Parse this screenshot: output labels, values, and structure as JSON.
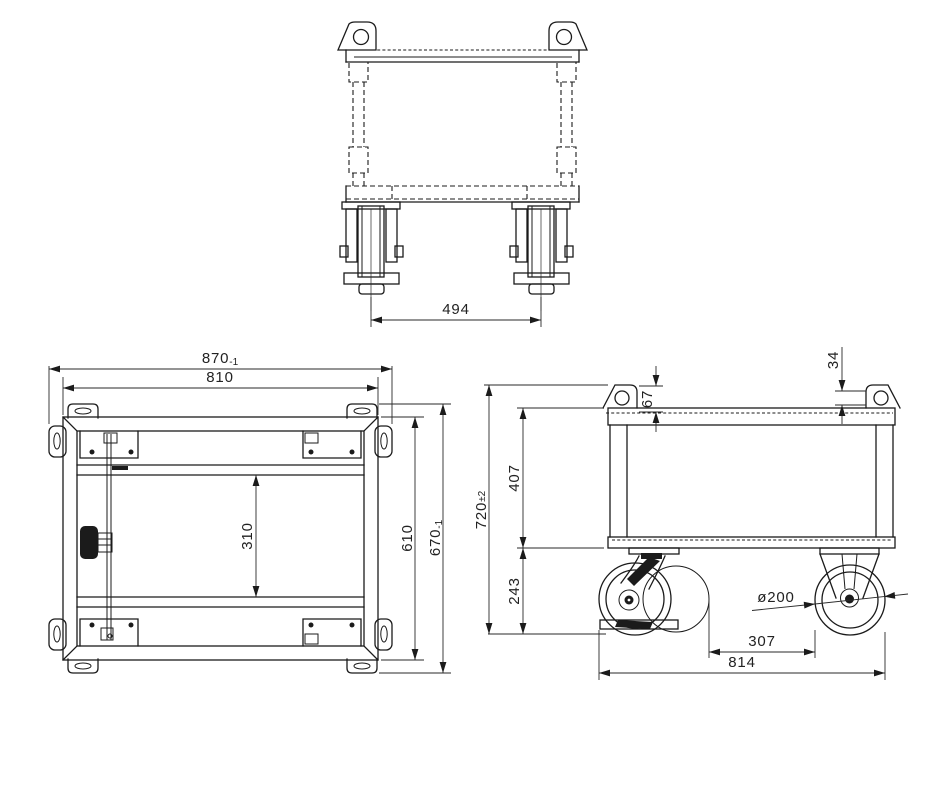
{
  "drawing": {
    "background": "#ffffff",
    "line_color": "#1b1b1b",
    "text_color": "#222222"
  },
  "front_view": {
    "dims": {
      "caster_spacing": "494"
    }
  },
  "plan_view": {
    "dims": {
      "overall_width": "870",
      "overall_width_tol": "-1",
      "frame_width": "810",
      "cross_rail_gap": "310",
      "frame_depth": "610",
      "overall_depth": "670",
      "overall_depth_tol": "-1"
    }
  },
  "side_view": {
    "dims": {
      "tab_hole_offset": "34",
      "tab_to_rail": "67",
      "frame_height": "407",
      "overall_height": "720",
      "overall_height_tol": "±2",
      "caster_height": "243",
      "wheel_diameter": "ø200",
      "swivel_to_wheel": "307",
      "overall_wheel_span": "814"
    }
  }
}
